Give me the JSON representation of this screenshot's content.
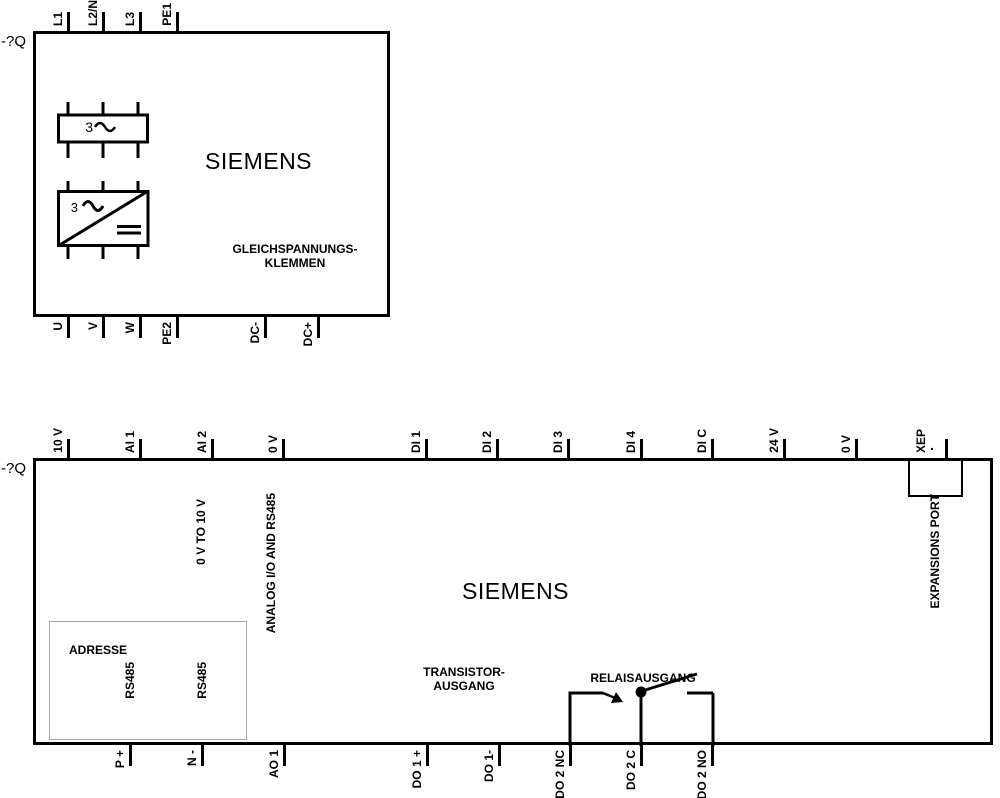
{
  "diagram": {
    "colors": {
      "line": "#000000",
      "background": "#ffffff",
      "muted_border": "#a6a6a6"
    },
    "device_top": {
      "ref_label": "-?Q",
      "brand": "SIEMENS",
      "caption_line1": "GLEICHSPANNUNGS-",
      "caption_line2": "KLEMMEN",
      "transformer_label": "3",
      "rectifier_label": "3",
      "terminals_top": [
        {
          "label": "L1",
          "x": 68
        },
        {
          "label": "L2/N",
          "x": 103
        },
        {
          "label": "L3",
          "x": 140
        },
        {
          "label": "PE1",
          "x": 177
        }
      ],
      "terminals_bottom": [
        {
          "label": "U",
          "x": 68
        },
        {
          "label": "V",
          "x": 103
        },
        {
          "label": "W",
          "x": 140
        },
        {
          "label": "PE2",
          "x": 177
        },
        {
          "label": "DC-",
          "x": 265
        },
        {
          "label": "DC+",
          "x": 318
        }
      ]
    },
    "device_bottom": {
      "ref_label": "-?Q",
      "brand": "SIEMENS",
      "analog_range_label": "0 V TO 10 V",
      "analog_bus_label": "ANALOG I/O AND RS485",
      "expansion_port_label": "EXPANSIONS PORT",
      "expansion_terminal_dot": ".",
      "address_label": "ADRESSE",
      "rs485_label_1": "RS485",
      "rs485_label_2": "RS485",
      "transistor_line1": "TRANSISTOR-",
      "transistor_line2": "AUSGANG",
      "relay_label": "RELAISAUSGANG",
      "terminals_top": [
        {
          "label": "10 V",
          "x": 68
        },
        {
          "label": "AI 1",
          "x": 140
        },
        {
          "label": "AI 2",
          "x": 212
        },
        {
          "label": "0 V",
          "x": 283
        },
        {
          "label": "DI 1",
          "x": 426
        },
        {
          "label": "DI 2",
          "x": 497
        },
        {
          "label": "DI 3",
          "x": 568
        },
        {
          "label": "DI 4",
          "x": 641
        },
        {
          "label": "DI C",
          "x": 712
        },
        {
          "label": "24 V",
          "x": 784
        },
        {
          "label": "0 V",
          "x": 856
        },
        {
          "label": "XEP",
          "x": 946,
          "label_offset": 15
        }
      ],
      "terminals_bottom": [
        {
          "label": "P +",
          "x": 130
        },
        {
          "label": "N -",
          "x": 202
        },
        {
          "label": "AO 1",
          "x": 284
        },
        {
          "label": "DO 1 +",
          "x": 427
        },
        {
          "label": "DO 1-",
          "x": 499
        },
        {
          "label": "DO 2 NC",
          "x": 570
        },
        {
          "label": "DO 2 C",
          "x": 641
        },
        {
          "label": "DO 2 NO",
          "x": 712
        }
      ]
    }
  }
}
